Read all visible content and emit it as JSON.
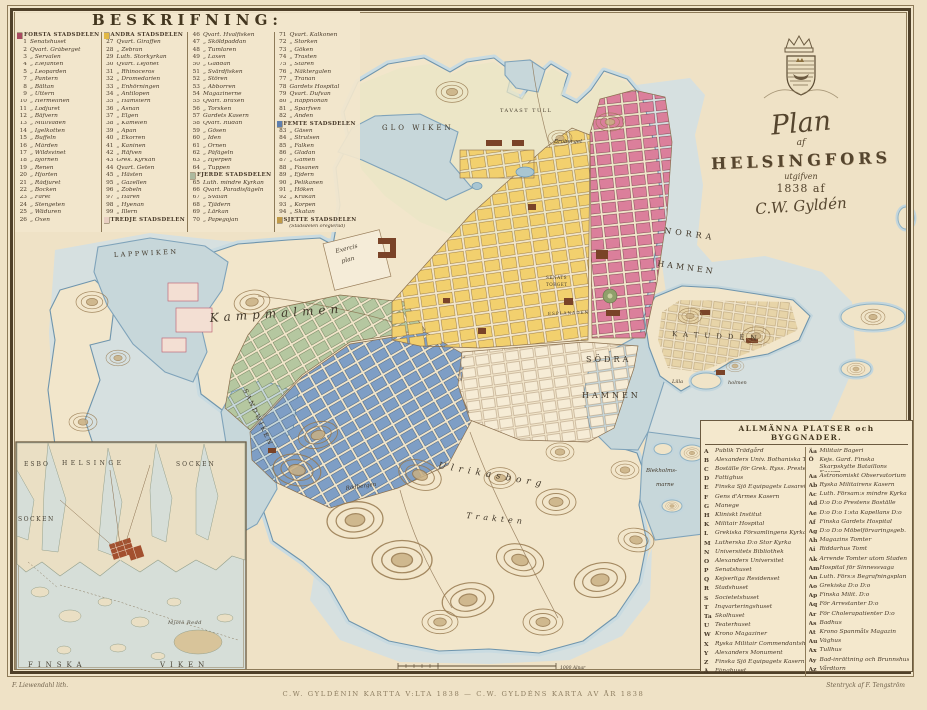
{
  "cartouche": {
    "plan": "Plan",
    "af": "af",
    "city": "HELSINGFORS",
    "utgifven": "utgifven",
    "year": "1838 af",
    "sign": "C.W. Gyldén"
  },
  "beskrifning": {
    "title": "BESKRIFNING:",
    "col1": [
      {
        "c": "h",
        "s": "#a84a60",
        "t": "FÖRSTA STADSDELEN"
      },
      {
        "n": "1",
        "t": "Senatshuset"
      },
      {
        "n": "2",
        "t": "Qvart. Gråberget"
      },
      {
        "n": "3",
        "t": "„ Servalen"
      },
      {
        "n": "4",
        "t": "„ Elefanten"
      },
      {
        "n": "5",
        "t": "„ Leoparden"
      },
      {
        "n": "7",
        "t": "„ Pantern"
      },
      {
        "n": "8",
        "t": "„ Bältan"
      },
      {
        "n": "9",
        "t": "„ Uttern"
      },
      {
        "n": "10",
        "t": "„ Hermelinen"
      },
      {
        "n": "11",
        "t": "„ Lodjuret"
      },
      {
        "n": "12",
        "t": "„ Bäfvern"
      },
      {
        "n": "13",
        "t": "„ Mullvaden"
      },
      {
        "n": "14",
        "t": "„ Igelkotten"
      },
      {
        "n": "15",
        "t": "„ Buffeln"
      },
      {
        "n": "16",
        "t": "„ Mården"
      },
      {
        "n": "17",
        "t": "„ Wildsvinet"
      },
      {
        "n": "18",
        "t": "„ Björnen"
      },
      {
        "n": "19",
        "t": "„ Renen"
      },
      {
        "n": "20",
        "t": "„ Hjorten"
      },
      {
        "n": "21",
        "t": "„ Rådjuret"
      },
      {
        "n": "22",
        "t": "„ Bocken"
      },
      {
        "n": "23",
        "t": "„ Fåret"
      },
      {
        "n": "24",
        "t": "„ Stengeten"
      },
      {
        "n": "25",
        "t": "„ Wäduren"
      },
      {
        "n": "26",
        "t": "„ Oxen"
      }
    ],
    "col2": [
      {
        "c": "h",
        "s": "#e2b844",
        "t": "ANDRA STADSDELEN"
      },
      {
        "n": "27",
        "t": "Qvart. Giraffen"
      },
      {
        "n": "28",
        "t": "„ Zebran"
      },
      {
        "n": "29",
        "t": "Luth. Storkyrkan"
      },
      {
        "n": "30",
        "t": "Qvart. Lejonet"
      },
      {
        "n": "31",
        "t": "„ Rhinoceros"
      },
      {
        "n": "32",
        "t": "„ Dromedarien"
      },
      {
        "n": "33",
        "t": "„ Enhörningen"
      },
      {
        "n": "34",
        "t": "„ Antilopen"
      },
      {
        "n": "35",
        "t": "„ Hamstern"
      },
      {
        "n": "36",
        "t": "„ Åsnan"
      },
      {
        "n": "37",
        "t": "„ Elgen"
      },
      {
        "n": "38",
        "t": "„ Kamelen"
      },
      {
        "n": "39",
        "t": "„ Apan"
      },
      {
        "n": "40",
        "t": "„ Ekorren"
      },
      {
        "n": "41",
        "t": "„ Kaninen"
      },
      {
        "n": "42",
        "t": "„ Räfven"
      },
      {
        "n": "43",
        "t": "Grek. Kyrkan"
      },
      {
        "n": "44",
        "t": "Qvart. Geten"
      },
      {
        "n": "45",
        "t": "„ Hästen"
      },
      {
        "n": "95",
        "t": "„ Gazellen"
      },
      {
        "n": "96",
        "t": "„ Zobeln"
      },
      {
        "n": "97",
        "t": "„ Haren"
      },
      {
        "n": "98",
        "t": "„ Hyenan"
      },
      {
        "n": "99",
        "t": "„ Illern"
      },
      {
        "c": "h",
        "s": "#e9cfc2",
        "t": "TREDJE STADSDELEN"
      }
    ],
    "col3": [
      {
        "n": "46",
        "t": "Qvart. Hvalfisken"
      },
      {
        "n": "47",
        "t": "„ Sköldpaddan"
      },
      {
        "n": "48",
        "t": "„ Tumlaren"
      },
      {
        "n": "49",
        "t": "„ Laxen"
      },
      {
        "n": "50",
        "t": "„ Gäddan"
      },
      {
        "n": "51",
        "t": "„ Svärdfisken"
      },
      {
        "n": "52",
        "t": "„ Stören"
      },
      {
        "n": "53",
        "t": "„ Abborren"
      },
      {
        "n": "54",
        "t": "Magazinerne"
      },
      {
        "n": "55",
        "t": "Qvart. Braxen"
      },
      {
        "n": "56",
        "t": "„ Torsken"
      },
      {
        "n": "57",
        "t": "Gardets Kasern"
      },
      {
        "n": "58",
        "t": "Qvart. Rudan"
      },
      {
        "n": "59",
        "t": "„ Gösen"
      },
      {
        "n": "60",
        "t": "„ Iden"
      },
      {
        "n": "61",
        "t": "„ Örnen"
      },
      {
        "n": "62",
        "t": "„ Påfågeln"
      },
      {
        "n": "63",
        "t": "„ Hjerpen"
      },
      {
        "n": "64",
        "t": "„ Tuppen"
      },
      {
        "c": "h",
        "s": "#adb99e",
        "t": "FJERDE STADSDELEN"
      },
      {
        "n": "65",
        "t": "Luth. mindre Kyrkan"
      },
      {
        "n": "66",
        "t": "Qvart. Paradisfågeln"
      },
      {
        "n": "67",
        "t": "„ Svalan"
      },
      {
        "n": "68",
        "t": "„ Tjädern"
      },
      {
        "n": "69",
        "t": "„ Lärkan"
      },
      {
        "n": "70",
        "t": "„ Papegojan"
      }
    ],
    "col4": [
      {
        "n": "71",
        "t": "Qvart. Kalkonen"
      },
      {
        "n": "72",
        "t": "„ Storken"
      },
      {
        "n": "73",
        "t": "„ Göken"
      },
      {
        "n": "74",
        "t": "„ Trasten"
      },
      {
        "n": "75",
        "t": "„ Staren"
      },
      {
        "n": "76",
        "t": "„ Näktergalen"
      },
      {
        "n": "77",
        "t": "„ Tranan"
      },
      {
        "n": "78",
        "t": "Gardets Hospital"
      },
      {
        "n": "79",
        "t": "Qvart. Dufvan"
      },
      {
        "n": "80",
        "t": "„ Rapphönan"
      },
      {
        "n": "81",
        "t": "„ Sparfven"
      },
      {
        "n": "82",
        "t": "„ Anden"
      },
      {
        "c": "h",
        "s": "#5f7fae",
        "t": "FEMTE STADSDELEN"
      },
      {
        "n": "83",
        "t": "„ Gåsen"
      },
      {
        "n": "84",
        "t": "„ Strutsen"
      },
      {
        "n": "85",
        "t": "„ Falken"
      },
      {
        "n": "86",
        "t": "„ Gladan"
      },
      {
        "n": "87",
        "t": "„ Gamen"
      },
      {
        "n": "88",
        "t": "„ Fasanen"
      },
      {
        "n": "89",
        "t": "„ Ejdern"
      },
      {
        "n": "90",
        "t": "„ Pelikanen"
      },
      {
        "n": "91",
        "t": "„ Höken"
      },
      {
        "n": "92",
        "t": "„ Kråkan"
      },
      {
        "n": "93",
        "t": "„ Korpen"
      },
      {
        "n": "94",
        "t": "„ Skatan"
      },
      {
        "c": "h",
        "s": "#c09a48",
        "t": "SJETTE STADSDELEN"
      },
      {
        "c": "hs",
        "t": "(Stadsdelen oreglerad)"
      }
    ]
  },
  "allmanna": {
    "title": "ALLMÄNNA PLATSER och BYGGNADER.",
    "left": [
      {
        "k": "A",
        "t": "Publik Trädgård"
      },
      {
        "k": "B",
        "t": "Alexanders Univ. Bothaniska Trädg."
      },
      {
        "k": "C",
        "t": "Boställe för Grek. Ryss. Prester"
      },
      {
        "k": "D",
        "t": "Fattighus"
      },
      {
        "k": "E",
        "t": "Finska Sjö Equipagets Lasarett"
      },
      {
        "k": "F",
        "t": "Gens d'Armes Kasern"
      },
      {
        "k": "G",
        "t": "Manege"
      },
      {
        "k": "H",
        "t": "Kliniskt Institut"
      },
      {
        "k": "K",
        "t": "Militair Hospital"
      },
      {
        "k": "L",
        "t": "Grekiska Församlingens Kyrka"
      },
      {
        "k": "M",
        "t": "Lutherska D:o Stor Kyrka"
      },
      {
        "k": "N",
        "t": "Universitets Bibliothek"
      },
      {
        "k": "O",
        "t": "Alexanders Universitet"
      },
      {
        "k": "P",
        "t": "Senatshuset"
      },
      {
        "k": "Q",
        "t": "Kejserliga Residenset"
      },
      {
        "k": "R",
        "t": "Stadshuset"
      },
      {
        "k": "S",
        "t": "Societetshuset"
      },
      {
        "k": "T",
        "t": "Inqvarteringshuset"
      },
      {
        "k": "Ta",
        "t": "Skolhuset"
      },
      {
        "k": "U",
        "t": "Teaterhuset"
      },
      {
        "k": "W",
        "t": "Krono Magaziner"
      },
      {
        "k": "X",
        "t": "Ryska Militair Commendantshuset"
      },
      {
        "k": "Y",
        "t": "Alexanders Monument"
      },
      {
        "k": "Z",
        "t": "Finska Sjö Equipagets Kasern"
      },
      {
        "k": "Å",
        "t": "Fånghuset"
      }
    ],
    "right": [
      {
        "k": "Äa",
        "t": "Militair Bageri"
      },
      {
        "k": "Ö",
        "t": "Kejs. Gard. Finska Skarpskytte Bataillons Kasern",
        "c": "w2"
      },
      {
        "k": "Aa",
        "t": "Astronomiskt Observatorium"
      },
      {
        "k": "Ab",
        "t": "Ryska Militairens Kasern"
      },
      {
        "k": "Ac",
        "t": "Luth. Försam:s mindre Kyrka"
      },
      {
        "k": "Ad",
        "t": "D:o D:o Prestens Boställe"
      },
      {
        "k": "Ae",
        "t": "D:o D:o 1:sta Kapellans D:o"
      },
      {
        "k": "Af",
        "t": "Finska Gardets Hospital"
      },
      {
        "k": "Ag",
        "t": "D:o D:o Möbelförvaringsgeb."
      },
      {
        "k": "Ah",
        "t": "Magazins Tomter"
      },
      {
        "k": "Ai",
        "t": "Riddarhus Tomt"
      },
      {
        "k": "Ak",
        "t": "Arrende Tomter utom Staden"
      },
      {
        "k": "Am",
        "t": "Hospital för Sinnessvaga"
      },
      {
        "k": "An",
        "t": "Luth. Förs:s Begrafningsplan"
      },
      {
        "k": "Ao",
        "t": "Grekiska D:o D:o"
      },
      {
        "k": "Ap",
        "t": "Finska Milit. D:o"
      },
      {
        "k": "Aq",
        "t": "För Arrestanter D:o"
      },
      {
        "k": "Ar",
        "t": "För Cholerapatienter D:o"
      },
      {
        "k": "As",
        "t": "Badhus"
      },
      {
        "k": "At",
        "t": "Krono Spanmåls Magazin"
      },
      {
        "k": "Au",
        "t": "Våghus"
      },
      {
        "k": "Ax",
        "t": "Tullhus"
      },
      {
        "k": "Ay",
        "t": "Bad-inrättning och Brunnshus"
      },
      {
        "k": "Az",
        "t": "Vårdtorn"
      }
    ]
  },
  "map": {
    "labels": {
      "glo_wiken": "GLO WIKEN",
      "tavast_tull": "TAVAST TULL",
      "broberget": "Broberget",
      "norra": "NORRA",
      "hamnen_n": "HAMNEN",
      "sodra": "SÖDRA",
      "hamnen_s": "HAMNEN",
      "katudden": "KATUDDEN",
      "lappwiken": "LAPPWIKEN",
      "kampmalmen": "Kampmalmen",
      "sandwiken": "SANDWIKEN",
      "exercis": "Exercis",
      "plan": "plan",
      "senats": "SENATS",
      "torget": "TORGET",
      "esplanaden": "ESPLANADEN",
      "ulrikasborg": "Ulrikasborg",
      "trakten": "Trakten",
      "rodbergen": "Rödbergen",
      "blekholm1": "Blekholms-",
      "blekholm2": "marne",
      "lilla": "Lilla",
      "holmen": "holmen",
      "scale": "1000 Alnar"
    }
  },
  "inset": {
    "labels": {
      "esbo": "ESBO",
      "helsinge": "HELSINGE",
      "socken_top": "SOCKEN",
      "socken_left": "SOCKEN",
      "finska": "FINSKA",
      "viken": "VIKEN",
      "mjolo": "Mjölö Redd"
    }
  },
  "credits": {
    "lith": "F. Liewendahl lith.",
    "print": "Stentryck af F. Tengström",
    "caption": "C.W. GYLDÉNIN KARTTA V:LTA 1838 — C.W. GYLDÉNS KARTA AV ÅR 1838"
  },
  "colors": {
    "district1": "#a84a60",
    "district2": "#e2b844",
    "district3": "#e9cfc2",
    "district4": "#adb99e",
    "district5": "#5f7fae",
    "district6": "#c09a48",
    "blocks_pink": "#db7f9b",
    "blocks_yellow": "#f2d06e",
    "blocks_blue": "#7e9ec5",
    "blocks_green": "#b5c7a0",
    "water": "#c7d7da",
    "paper": "#f2e6cb"
  }
}
